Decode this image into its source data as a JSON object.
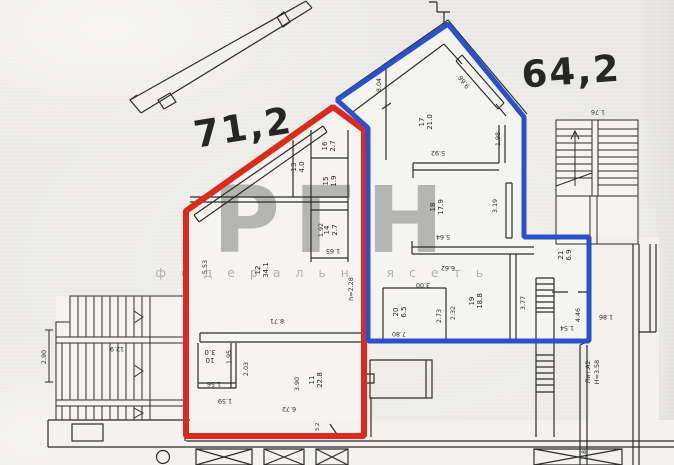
{
  "areas": {
    "red": {
      "label": "71,2"
    },
    "blue": {
      "label": "64,2"
    }
  },
  "watermark": {
    "logo": "РГН",
    "tagline": "ф е д е р а л ь н а я   с е т ь"
  },
  "rooms": {
    "r10": {
      "num": "10",
      "area": "3.0"
    },
    "r11": {
      "num": "11",
      "area": "22.8"
    },
    "r12": {
      "num": "12",
      "area": "34.1"
    },
    "r13": {
      "num": "13",
      "area": "4.0"
    },
    "r14": {
      "num": "14",
      "area": "2.7"
    },
    "r15": {
      "num": "15",
      "area": "1.9"
    },
    "r16": {
      "num": "16",
      "area": "2.7"
    },
    "r17": {
      "num": "17",
      "area": "21.0"
    },
    "r18": {
      "num": "18",
      "area": "17.9"
    },
    "r19": {
      "num": "19",
      "area": "18.8"
    },
    "r20": {
      "num": "20",
      "area": "6.5"
    },
    "r21": {
      "num": "21",
      "area": "6.9"
    }
  },
  "dims": {
    "d290": "2.90",
    "d129": "12.9",
    "d553": "5.53",
    "d871": "8.71",
    "d195": "1.95",
    "d203": "2.03",
    "d156": "1.56",
    "d159": "1.59",
    "d390": "3.90",
    "d672": "6.72",
    "d192": "1.92",
    "d165": "1.65",
    "d32": "3.2",
    "h228": "h=2.28",
    "d804": "8.04",
    "d966": "9.66",
    "d198": "1.98",
    "d592": "5.92",
    "d319": "3.19",
    "d564": "5.64",
    "d662": "6.62",
    "d300": "3.00",
    "d273": "2.73",
    "d232": "2.32",
    "d377": "3.77",
    "d446": "4.46",
    "d154": "1.54",
    "d186": "1.86",
    "d780": "7.80",
    "d176": "1.76",
    "d18": "1.8"
  },
  "annotations": {
    "lit": "Лит.А2",
    "height": "Н=3.58"
  },
  "colors": {
    "red": "#dd2a1e",
    "blue": "#2b50cc",
    "watermark_logo": "#cf4f59",
    "walls": "#2e2d2a"
  }
}
